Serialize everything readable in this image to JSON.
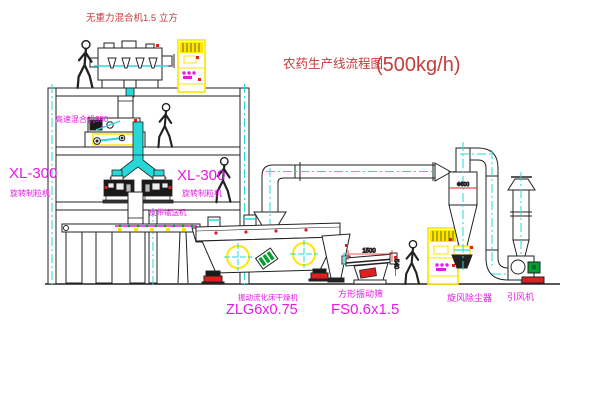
{
  "title": {
    "name": "农药生产线流程图",
    "capacity": "(500kg/h)"
  },
  "equipment": {
    "gravity_mixer": {
      "label": "无重力混合机1.5 立方"
    },
    "high_speed_mixer": {
      "label": "高速混合机350"
    },
    "granulator_left": {
      "model": "XL-300",
      "name": "旋转制粒机"
    },
    "granulator_right": {
      "model": "XL-300",
      "name": "旋转制粒机"
    },
    "belt_conveyor": {
      "label": "皮带输送机"
    },
    "fluid_bed_dryer": {
      "name": "振动流化床干燥机",
      "model": "ZLG6x0.75"
    },
    "vibrating_screen": {
      "name": "方形振动筛",
      "model": "FS0.6x1.5",
      "dim_length": "1500",
      "dim_height": "540"
    },
    "cyclone": {
      "name": "旋风除尘器",
      "dim": "Φ500"
    },
    "induced_draft_fan": {
      "name": "引风机"
    }
  },
  "colors": {
    "label_magenta": "#e61ae6",
    "label_red": "#c43c3c",
    "dim_red": "#e02020",
    "centerline_cyan": "#27d8d8",
    "cabinet_yellow": "#ffe500",
    "motor_green": "#00a332",
    "line": "#222222"
  }
}
